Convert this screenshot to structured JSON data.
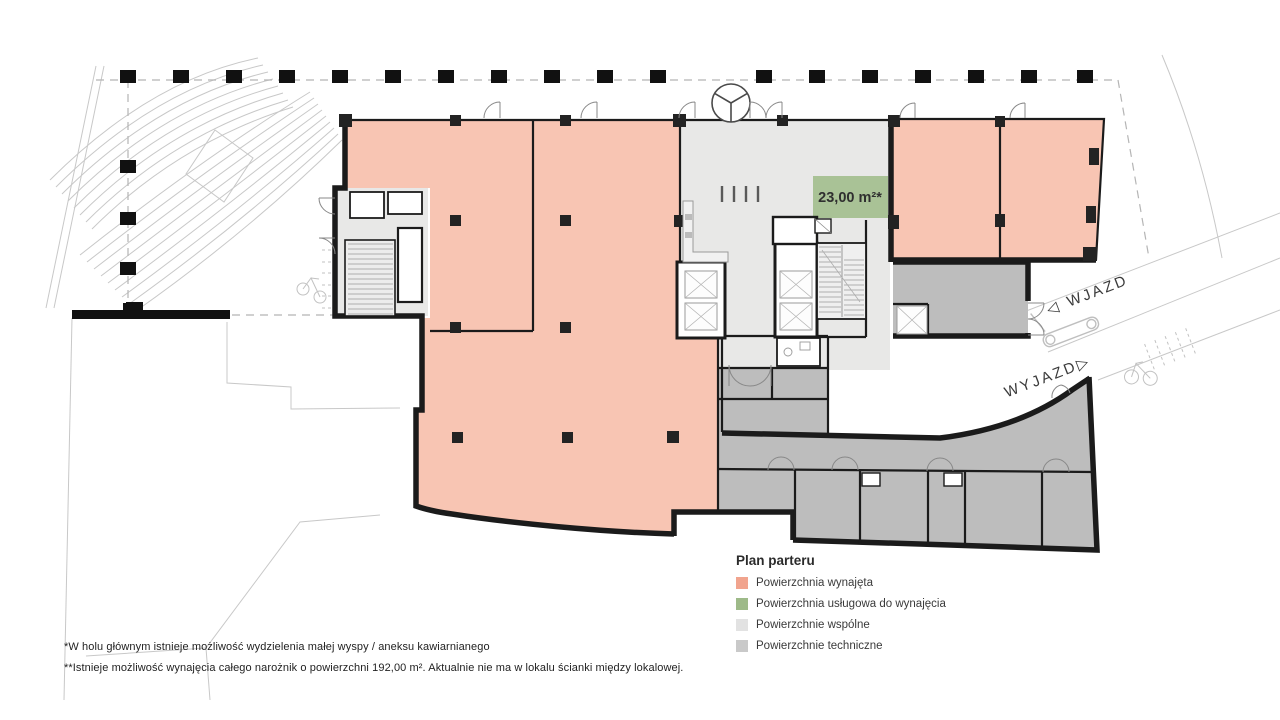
{
  "plan": {
    "service_area_label": "23,00 m²*",
    "entry_arrow": "◁",
    "entry_label": "WJAZD",
    "exit_label": "WYJAZD",
    "exit_arrow": "▷"
  },
  "legend": {
    "title": "Plan parteru",
    "items": [
      {
        "label": "Powierzchnia wynajęta",
        "color": "#f1a48e"
      },
      {
        "label": "Powierzchnia usługowa do wynajęcia",
        "color": "#9eba89"
      },
      {
        "label": "Powierzchnie wspólne",
        "color": "#e2e2e2"
      },
      {
        "label": "Powierzchnie techniczne",
        "color": "#c9c9c9"
      }
    ]
  },
  "footnotes": [
    "*W holu głównym istnieje możliwość wydzielenia małej wyspy / aneksu kawiarnianego",
    "**Istnieje możliwość wynajęcia całego narożnik o powierzchni 192,00 m². Aktualnie nie ma w lokalu ścianki między lokalowej."
  ],
  "colors": {
    "rented": "#f8c5b3",
    "service": "#a9c296",
    "common": "#e8e8e7",
    "technical": "#bdbdbd",
    "wall": "#1b1b1b"
  }
}
